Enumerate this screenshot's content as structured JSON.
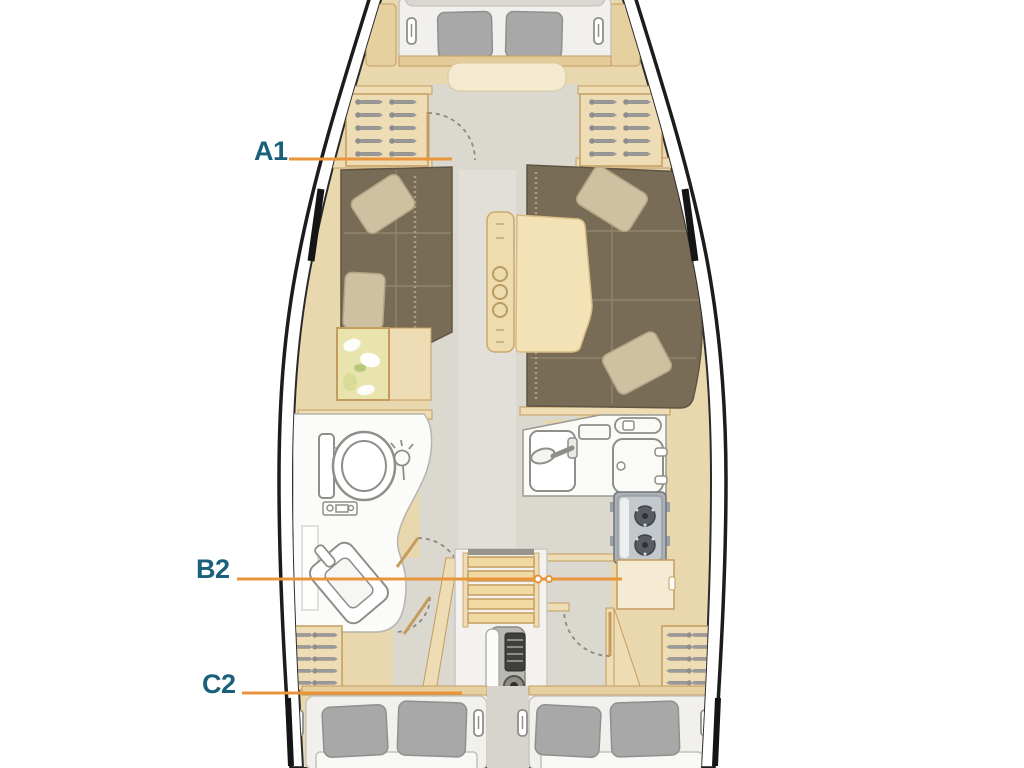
{
  "diagram": {
    "type": "yacht-deck-plan",
    "labels": {
      "a1": "A1",
      "b2": "B2",
      "c2": "C2"
    }
  },
  "colors": {
    "label_text": "#1a5f7c",
    "leader_line": "#e8953c",
    "hull_outline": "#1c1c1c",
    "interior_wood": "#e9d7ae",
    "cabinetry": "#eddcb4",
    "floor": "#dbd8d0",
    "upholstery": "#796c57",
    "pillow_tan": "#cec0a0",
    "pillow_gray": "#a8a8a8",
    "mattress_white": "#f1f0ec",
    "stove_gray": "#b0b5ba"
  },
  "icons": {
    "hanger": "clothes-hanger rows in lockers",
    "toilet": "toilet top view",
    "shower": "shower-head circle with spray",
    "sink": "galley sink with faucet",
    "fridge": "top-opening fridge",
    "stove": "gimbaled 2-burner stove",
    "steps": "companionway ladder",
    "engine": "engine block",
    "door-swing": "dashed door arc",
    "bed-pillow": "pillows on berths",
    "reading-light": "berth reading light",
    "chart-map": "nav chart on table",
    "bottle-holder": "salon table bottle holder"
  }
}
